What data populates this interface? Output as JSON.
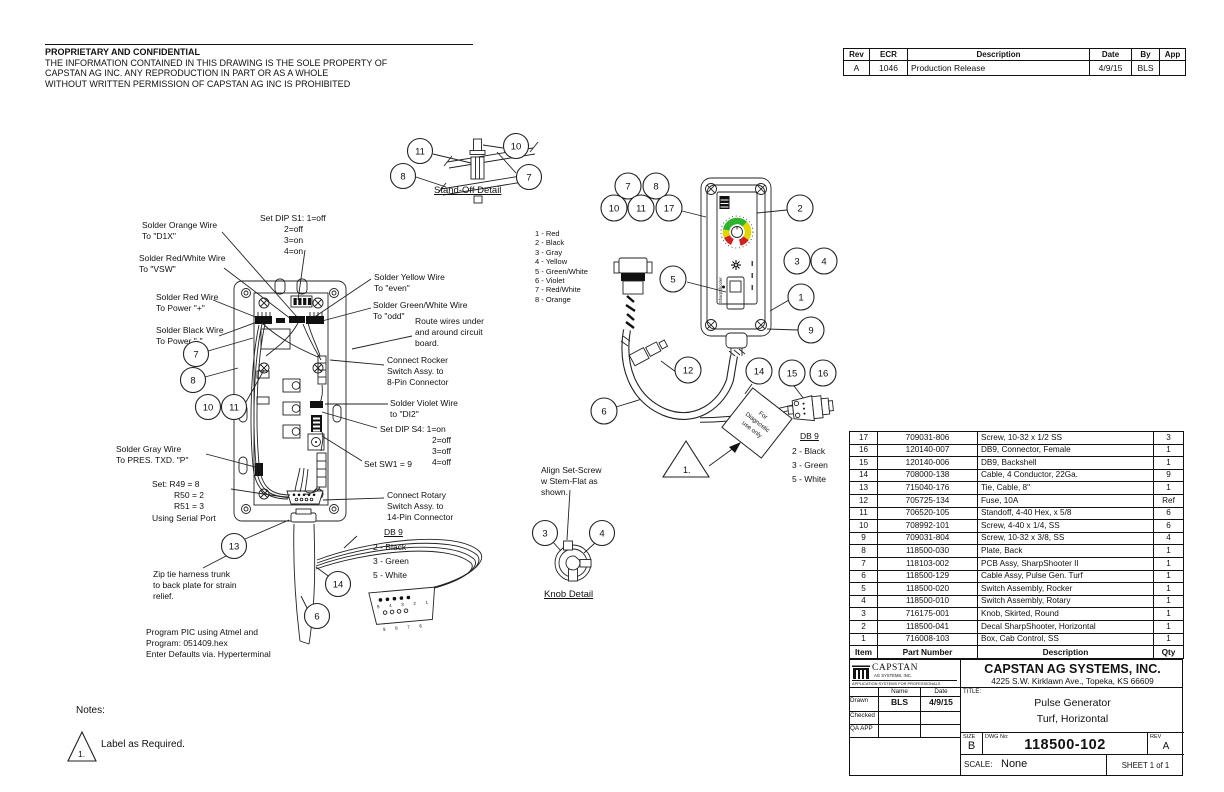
{
  "notice": {
    "title": "PROPRIETARY AND CONFIDENTIAL",
    "body": "THE INFORMATION CONTAINED IN THIS DRAWING IS THE SOLE PROPERTY OF\nCAPSTAN AG INC. ANY REPRODUCTION IN PART OR AS A WHOLE\nWITHOUT WRITTEN PERMISSION OF CAPSTAN AG INC IS PROHIBITED"
  },
  "rev_table": {
    "headers": [
      "Rev",
      "ECR",
      "Description",
      "Date",
      "By",
      "App"
    ],
    "rows": [
      [
        "A",
        "1046",
        "Production Release",
        "4/9/15",
        "BLS",
        ""
      ]
    ]
  },
  "parts_table": {
    "headers": [
      "Item",
      "Part Number",
      "Description",
      "Qty"
    ],
    "rows": [
      [
        "17",
        "709031-806",
        "Screw, 10-32 x 1/2 SS",
        "3"
      ],
      [
        "16",
        "120140-007",
        "DB9, Connector, Female",
        "1"
      ],
      [
        "15",
        "120140-006",
        "DB9, Backshell",
        "1"
      ],
      [
        "14",
        "708000-138",
        "Cable, 4 Conductor, 22Ga.",
        "9"
      ],
      [
        "13",
        "715040-176",
        "Tie, Cable, 8\"",
        "1"
      ],
      [
        "12",
        "705725-134",
        "Fuse, 10A",
        "Ref"
      ],
      [
        "11",
        "706520-105",
        "Standoff, 4-40 Hex, x 5/8",
        "6"
      ],
      [
        "10",
        "708992-101",
        "Screw, 4-40 x 1/4, SS",
        "6"
      ],
      [
        "9",
        "709031-804",
        "Screw, 10-32 x 3/8, SS",
        "4"
      ],
      [
        "8",
        "118500-030",
        "Plate, Back",
        "1"
      ],
      [
        "7",
        "118103-002",
        "PCB Assy, SharpShooter II",
        "1"
      ],
      [
        "6",
        "118500-129",
        "Cable Assy, Pulse Gen. Turf",
        "1"
      ],
      [
        "5",
        "118500-020",
        "Switch Assembly, Rocker",
        "1"
      ],
      [
        "4",
        "118500-010",
        "Switch Assembly, Rotary",
        "1"
      ],
      [
        "3",
        "716175-001",
        "Knob, Skirted, Round",
        "1"
      ],
      [
        "2",
        "118500-041",
        "Decal SharpShooter, Horizontal",
        "1"
      ],
      [
        "1",
        "716008-103",
        "Box, Cab Control, SS",
        "1"
      ]
    ]
  },
  "title_block": {
    "logo_name": "CAPSTAN",
    "logo_sub": "AG SYSTEMS, INC.",
    "logo_tagline": "APPLICATION SYSTEMS FOR PROFESSIONALS",
    "company": "CAPSTAN AG SYSTEMS, INC.",
    "address": "4225 S.W. Kirklawn Ave., Topeka, KS 66609",
    "name_col": "Name",
    "date_col": "Date",
    "drawn_label": "Drawn",
    "checked_label": "Checked",
    "qa_label": "QA APP",
    "drawn_name": "BLS",
    "drawn_date": "4/9/15",
    "title_label": "TITLE:",
    "title_line1": "Pulse Generator",
    "title_line2": "Turf, Horizontal",
    "size_label": "SIZE",
    "size": "B",
    "dwg_label": "DWG No:",
    "dwg_no": "118500-102",
    "rev_label": "REV",
    "rev": "A",
    "scale_label": "SCALE:",
    "scale": "None",
    "sheet": "SHEET 1 of 1"
  },
  "annotations": {
    "solder_orange": "Solder Orange Wire\nTo \"D1X\"",
    "dip_s1_head": "Set DIP S1: 1=off",
    "dip_s1_rest": "2=off\n3=on\n4=on",
    "solder_red_white": "Solder Red/White Wire\nTo \"VSW\"",
    "solder_red": "Solder Red Wire\nTo Power \"+\"",
    "solder_black": "Solder Black Wire\nTo Power \"-\"",
    "solder_gray": "Solder Gray Wire\nTo PRES. TXD. \"P\"",
    "set_r_head": "Set: R49 = 8",
    "set_r_mid": "R50 = 2\nR51 = 3",
    "set_r_tail": "Using Serial Port",
    "zip_tie": "Zip tie harness trunk\nto back plate for strain\nrelief.",
    "program": "Program PIC using Atmel and\nProgram: 051409.hex\nEnter Defaults via. Hyperterminal",
    "solder_yellow": "Solder Yellow Wire\nTo \"even\"",
    "solder_green_white": "Solder Green/White Wire\nTo \"odd\"",
    "route_wires": "Route wires under\nand around circuit\nboard.",
    "connect_rocker": "Connect Rocker\nSwitch Assy. to\n8-Pin Connector",
    "solder_violet": "Solder Violet Wire\nto \"DI2\"",
    "dip_s4_head": "Set DIP S4: 1=on",
    "dip_s4_rest": "2=off\n3=off\n4=off",
    "set_sw1": "Set SW1 = 9",
    "connect_rotary": "Connect Rotary\nSwitch Assy. to\n14-Pin Connector",
    "align_set_screw": "Align Set-Screw\nw Stem-Flat as\nshown.",
    "diag_l1": "For",
    "diag_l2": "Diagnostic",
    "diag_l3": "use only"
  },
  "wire_list": [
    "1 - Red",
    "2 - Black",
    "3 - Gray",
    "4 - Yellow",
    "5 - Green/White",
    "6 - Violet",
    "7 - Red/White",
    "8 - Orange"
  ],
  "db9": {
    "header": "DB 9",
    "items": [
      "2 - Black",
      "3 - Green",
      "5 - White"
    ],
    "pins_top": "5 4 3 2 1",
    "pins_bottom": "9 8 7 6"
  },
  "details": {
    "standoff_title": "Stand-Off Detail",
    "knob_title": "Knob Detail"
  },
  "notes": {
    "label": "Notes:",
    "num": "1.",
    "note1": "Label as Required."
  },
  "decal": {
    "brand": "SharpShooter"
  },
  "callouts": {
    "c1": "1",
    "c2": "2",
    "c3": "3",
    "c4": "4",
    "c5": "5",
    "c6": "6",
    "c7": "7",
    "c8": "8",
    "c9": "9",
    "c10": "10",
    "c11": "11",
    "c12": "12",
    "c13": "13",
    "c14": "14",
    "c15": "15",
    "c16": "16",
    "c17": "17"
  },
  "colors": {
    "gauge_green": "#2db32d",
    "gauge_yellow": "#e3d600",
    "gauge_red": "#d22020"
  }
}
